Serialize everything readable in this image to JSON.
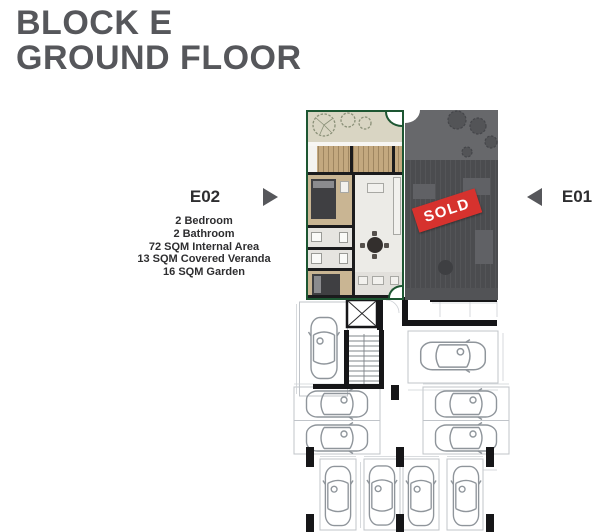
{
  "title": {
    "line1": "BLOCK E",
    "line2": "GROUND FLOOR"
  },
  "units": {
    "e02": {
      "label": "E02",
      "details": [
        "2 Bedroom",
        "2 Bathroom",
        "72 SQM Internal Area",
        "13 SQM Covered Veranda",
        "16 SQM Garden"
      ]
    },
    "e01": {
      "label": "E01",
      "status": "SOLD"
    }
  },
  "colors": {
    "title_grey": "#56575b",
    "accent_green": "#1d5632",
    "sold_red": "#d6322e",
    "sold_overlay_grey": "#58595c",
    "garden_beige": "#d9d5c3",
    "deck_tan": "#c3a87f"
  }
}
